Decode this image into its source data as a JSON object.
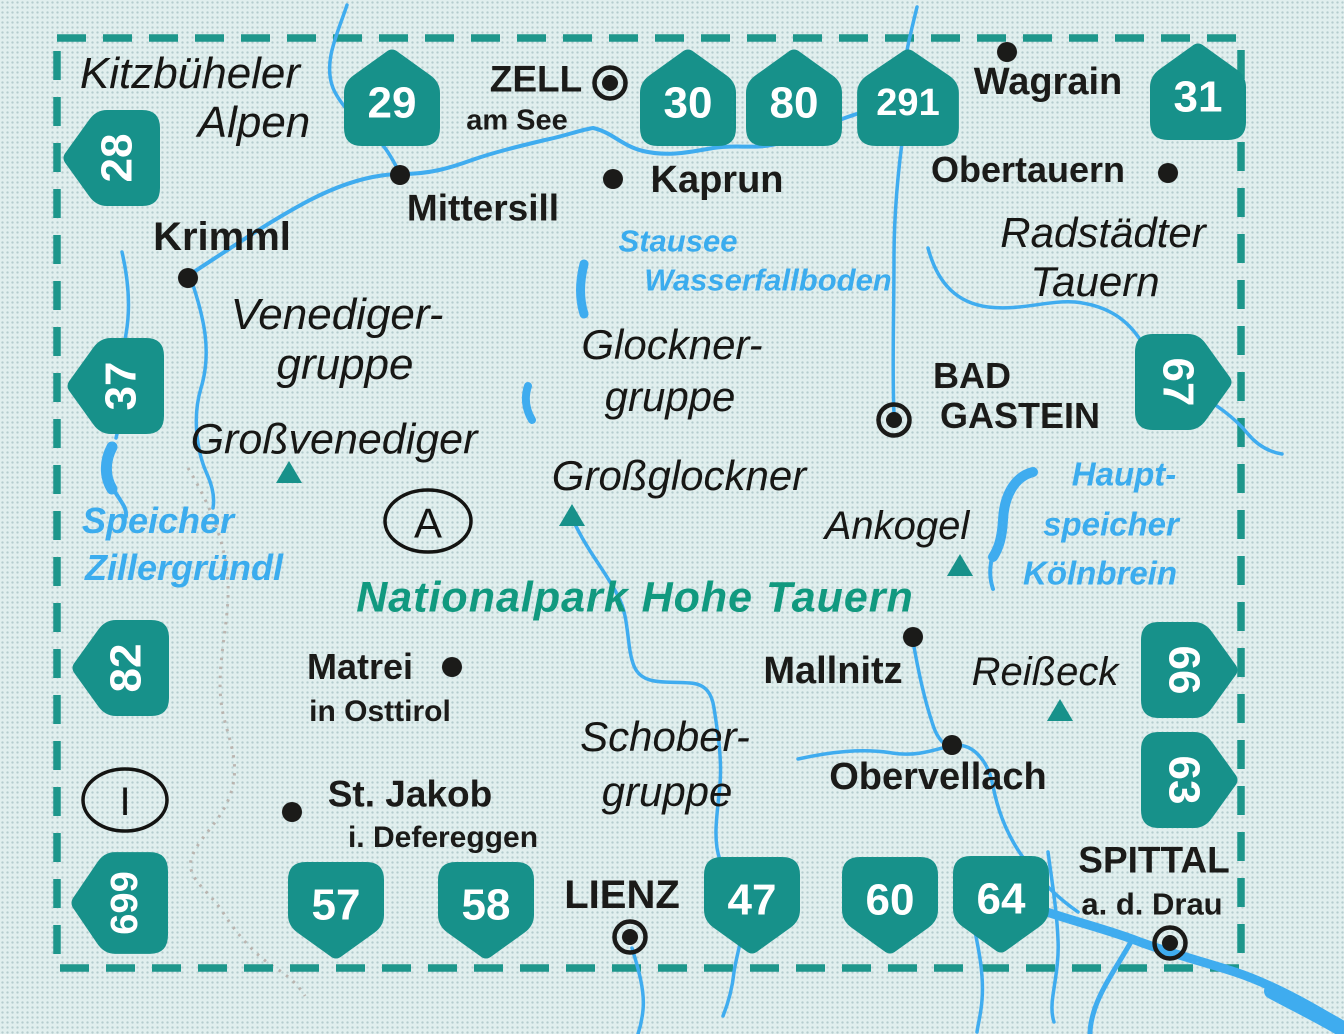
{
  "map_title": "Hohe Tauern map sheet index",
  "colors": {
    "badge_teal": "#17918a",
    "frame_teal": "#1d968b",
    "river_blue": "#3facef",
    "water_text_blue": "#3bacee",
    "park_text_teal": "#11997f",
    "background": "#e1efee",
    "label_black": "#1b1b19",
    "country_border_gray": "#b5aba6"
  },
  "labels": {
    "kitzbuheler_1": "Kitzbüheler",
    "kitzbuheler_2": "Alpen",
    "zell_1": "ZELL",
    "zell_2": "am See",
    "mittersill": "Mittersill",
    "krimml": "Krimml",
    "kaprun": "Kaprun",
    "wagrain": "Wagrain",
    "obertauern": "Obertauern",
    "radstadter_1": "Radstädter",
    "radstadter_2": "Tauern",
    "stausee_1": "Stausee",
    "stausee_2": "Wasserfallboden",
    "venediger_1": "Venediger-",
    "venediger_2": "gruppe",
    "glockner_1": "Glockner-",
    "glockner_2": "gruppe",
    "grossvenediger": "Großvenediger",
    "bad_gastein_1": "BAD",
    "bad_gastein_2": "GASTEIN",
    "grossglockner": "Großglockner",
    "ankogel": "Ankogel",
    "hauptspeicher_1": "Haupt-",
    "hauptspeicher_2": "speicher",
    "hauptspeicher_3": "Kölnbrein",
    "speicher_1": "Speicher",
    "speicher_2": "Zillergründl",
    "nationalpark": "Nationalpark Hohe Tauern",
    "matrei_1": "Matrei",
    "matrei_2": "in Osttirol",
    "mallnitz": "Mallnitz",
    "reisseck": "Reißeck",
    "obervellach": "Obervellach",
    "schober_1": "Schober-",
    "schober_2": "gruppe",
    "st_jakob_1": "St. Jakob",
    "st_jakob_2": "i. Defereggen",
    "lienz": "LIENZ",
    "spittal_1": "SPITTAL",
    "spittal_2": "a. d. Drau"
  },
  "badges": [
    {
      "label": "28"
    },
    {
      "label": "29"
    },
    {
      "label": "30"
    },
    {
      "label": "80"
    },
    {
      "label": "291"
    },
    {
      "label": "31"
    },
    {
      "label": "37"
    },
    {
      "label": "67"
    },
    {
      "label": "82"
    },
    {
      "label": "66"
    },
    {
      "label": "63"
    },
    {
      "label": "699"
    },
    {
      "label": "57"
    },
    {
      "label": "58"
    },
    {
      "label": "47"
    },
    {
      "label": "60"
    },
    {
      "label": "64"
    }
  ],
  "symbols": {
    "country_a": "A",
    "country_i": "I"
  }
}
